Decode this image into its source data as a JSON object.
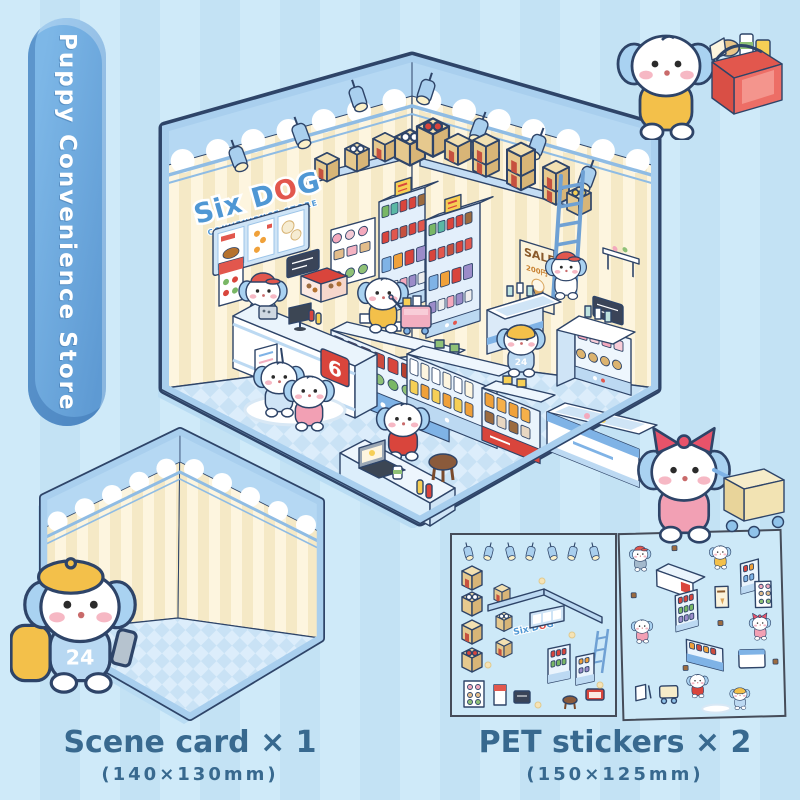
{
  "page": {
    "background": "#c6e3f4",
    "stripe": "#cfeaf9",
    "accent": "#5e9ad3",
    "outline": "#2e4468"
  },
  "banner": {
    "text": "Puppy Convenience Store"
  },
  "store": {
    "sign_part1": "Six D",
    "sign_part2": "O",
    "sign_part3": "G",
    "sign_subtitle": "CONVENIENCE STORE",
    "counter_badge": "6",
    "clerk_badge": "24",
    "sale_poster": {
      "title": "SALE",
      "price": "200円"
    }
  },
  "labels": {
    "scene_card": {
      "title": "Scene card × 1",
      "size": "(140×130mm)"
    },
    "pet_stickers": {
      "title": "PET stickers × 2",
      "size": "(150×125mm)"
    }
  },
  "characters": [
    {
      "id": "cashier",
      "desc": "cashier puppy with red cap behind checkout counter",
      "outfit": "#a3b9cc",
      "hat": "cap",
      "hat_color": "#e2574d"
    },
    {
      "id": "shopper-cart",
      "desc": "puppy in yellow coat pushing pink mini cart",
      "outfit": "#f3c04a",
      "hat": "none"
    },
    {
      "id": "clerk-24",
      "desc": "clerk puppy with yellow visor and No.24 blue shirt",
      "outfit": "#bcd9f2",
      "hat": "visor",
      "hat_color": "#f3c04a",
      "badge": "24"
    },
    {
      "id": "ladder-puppy",
      "desc": "puppy with red cap on ladder hanging a sign",
      "outfit": "#ffffff",
      "hat": "cap",
      "hat_color": "#e2574d"
    },
    {
      "id": "laptop-puppy",
      "desc": "puppy in red hoodie at snack counter with laptop",
      "outfit": "#d9453c",
      "hat": "none"
    },
    {
      "id": "girl-blue",
      "desc": "puppy in light blue outfit",
      "outfit": "#cfe4f6",
      "hat": "none"
    },
    {
      "id": "girl-pink",
      "desc": "girl puppy with pink skirt",
      "outfit": "#f2a0b4",
      "hat": "none"
    },
    {
      "id": "basket-shopper",
      "desc": "puppy with yellow hoodie carrying red shopping basket",
      "outfit": "#f3c04a",
      "hat": "none"
    },
    {
      "id": "card-clerk",
      "desc": "clerk puppy with yellow beret, backpack, phone and No.24 vest",
      "outfit": "#b8d8f2",
      "hat": "beret",
      "hat_color": "#f3c04a",
      "badge": "24"
    },
    {
      "id": "girl-cart",
      "desc": "girl puppy with red bow pushing cream shopping cart",
      "outfit": "#f2a0b4",
      "hat": "bow",
      "hat_color": "#e8536a"
    }
  ],
  "sticker_sheets": [
    {
      "name": "sheet-1",
      "items": [
        "ceiling lights",
        "cardboard boxes",
        "wall shelf",
        "ladder",
        "menu board",
        "Six DOG sign",
        "drink coolers",
        "bakery shelf",
        "poster",
        "blackboard",
        "stool",
        "hot food case",
        "paw flowers"
      ]
    },
    {
      "name": "sheet-2",
      "items": [
        "puppy characters",
        "checkout counter",
        "drink coolers",
        "snack gondola",
        "ice-cream freezer",
        "sale poster",
        "bakery rack",
        "shopping cart",
        "a-frame sign",
        "floor mat"
      ]
    }
  ]
}
